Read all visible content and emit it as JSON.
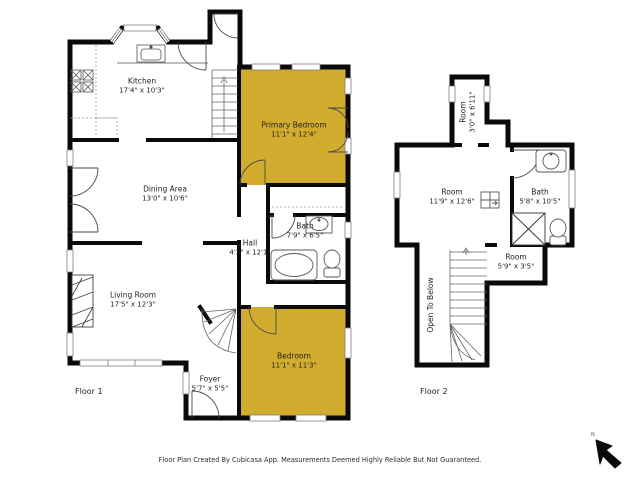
{
  "colors": {
    "highlight": "#D2AC2E",
    "wall": "#0A0A0A"
  },
  "footer": {
    "text": "Floor Plan Created By Cubicasa App. Measurements Deemed Highly Reliable But Not Guaranteed."
  },
  "compass": {
    "label": "N"
  },
  "floor1": {
    "label": "Floor 1",
    "rooms": {
      "kitchen": {
        "name": "Kitchen",
        "dims": "17'4\" x 10'3\""
      },
      "primary_bedroom": {
        "name": "Primary Bedroom",
        "dims": "11'1\" x 12'4\""
      },
      "dining": {
        "name": "Dining Area",
        "dims": "13'0\" x 10'6\""
      },
      "bath": {
        "name": "Bath",
        "dims": "7'9\" x 6'5\""
      },
      "hall": {
        "name": "Hall",
        "dims": "4'3\" x 12'1\""
      },
      "living": {
        "name": "Living Room",
        "dims": "17'5\" x 12'3\""
      },
      "bedroom": {
        "name": "Bedroom",
        "dims": "11'1\" x 11'3\""
      },
      "foyer": {
        "name": "Foyer",
        "dims": "5'7\" x 5'5\""
      }
    }
  },
  "floor2": {
    "label": "Floor 2",
    "rooms": {
      "room_top": {
        "name": "Room",
        "dims": "3'0\" x 6'11\""
      },
      "room_main": {
        "name": "Room",
        "dims": "11'9\" x 12'6\""
      },
      "bath": {
        "name": "Bath",
        "dims": "5'8\" x 10'5\""
      },
      "open_below": {
        "name": "Open To Below"
      },
      "room_bottom": {
        "name": "Room",
        "dims": "5'9\" x 3'5\""
      }
    }
  }
}
